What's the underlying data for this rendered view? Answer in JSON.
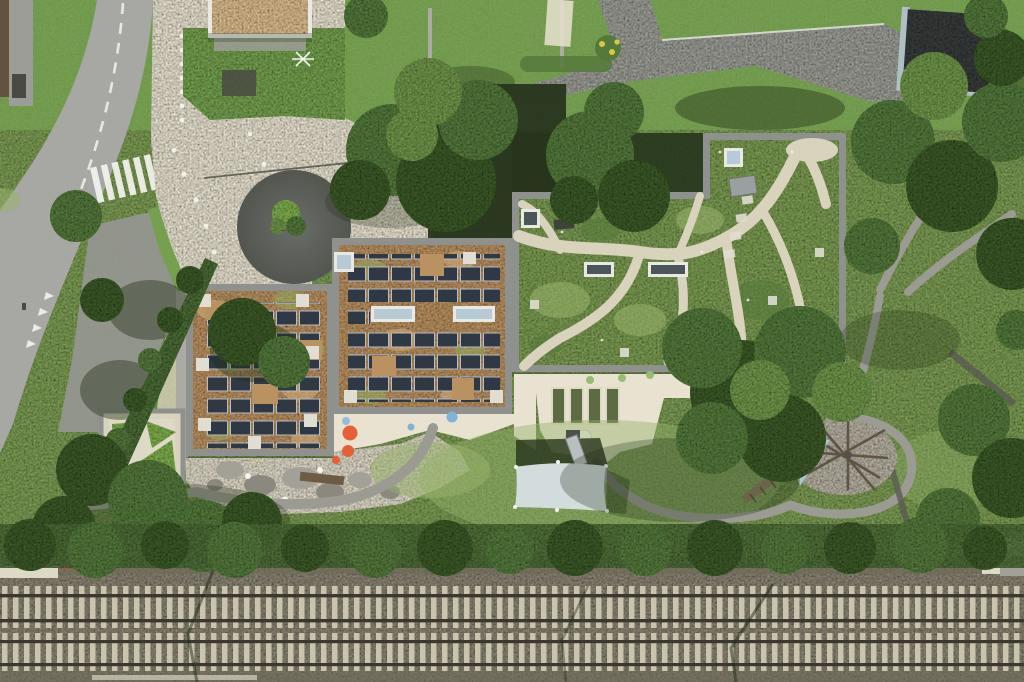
{
  "scene": {
    "type": "aerial-drone-photograph",
    "description": "Top-down aerial view of a kindergarten building with sedum green roofs: two roof sections carry rows of solar panels, a larger eastern roof section is a roof garden with winding gravel paths and skylights. Around the building: an entrance plaza with a dark tree circle, an access road with zebra crossing, neighbouring houses and driveways at the top, a playground with a white shade sail, raised garden beds, a rock garden, a timber climbing structure with a light-blue sail, a small shelter with triangular green roof patches, a hedge row, and a double railway track corridor across the bottom.",
    "features": [
      "curved road with zebra crossing and yield markings",
      "entrance plaza with bollard dots and circular tree planter",
      "west roof: sedum with solar panel array and white service pads",
      "center roof: sedum with solar panels and light-blue skylights",
      "east roof: green roof garden with gravel paths, skylights, vent box",
      "courtyard with orange and blue play dots",
      "four raised garden beds with green dots and white play tent",
      "rock garden with boulders and log",
      "white shade sail over play pit with slide",
      "gravel circle with timber climbing frame and blue triangular sail",
      "shelter roof with three triangular green patches",
      "lawns, large trees, hedge row",
      "two-track railway with sleepers, rails and mast shadows",
      "neighbour house with tan flat roof (top left)",
      "neighbour house with dark roof (top right)"
    ],
    "counts": {
      "railway_tracks": 2,
      "rails_visible": 4,
      "solar_roof_sections": 2,
      "garden_beds": 4,
      "shade_sails": 2
    }
  },
  "colors": {
    "grass": "#7d9c55",
    "grassLight": "#95b16a",
    "grassDark": "#5f813f",
    "lawn": "#74a050",
    "treeDark": "#3c5a2c",
    "treeMid": "#55793c",
    "treeLight": "#6f954b",
    "treeBright": "#7fae4e",
    "shadow": "#1e2a15",
    "deepShade": "#27351d",
    "road": "#a7a7a3",
    "roadDark": "#95968f",
    "driveway": "#9d9d97",
    "pathGrey": "#9b9b93",
    "plaza": "#e9e2d0",
    "concrete": "#ded8c6",
    "gravelPath": "#d9d2bd",
    "parapet": "#8e918d",
    "wallGrey": "#abaaa4",
    "sedumTan": "#ba9160",
    "sedumGreen": "#93a75e",
    "sedumLight": "#d0ab79",
    "roofGreen": "#7c9b52",
    "roofGreenL": "#99b46b",
    "solar": "#2f3945",
    "solarFrame": "#b8bdc3",
    "skyBlue": "#b6cbd5",
    "skyDark": "#4c555a",
    "frameWhite": "#e9e9e4",
    "pad": "#e0ddd2",
    "rock": "#a3a098",
    "rockDark": "#8b887f",
    "sailWhite": "#d3dcdd",
    "sailBlue": "#a9c7d7",
    "dotOrange": "#e55f38",
    "dotBlue": "#7fb3d8",
    "dotGreen": "#98bd72",
    "ballast": "#8a8472",
    "ballastDark": "#6e6958",
    "sleeper": "#cac3ae",
    "rail": "#3a382f",
    "hedge": "#4c6c39",
    "houseTan": "#dcbc8e",
    "houseDark": "#3a3d3c",
    "houseTrim": "#aec0c4",
    "fenceBrown": "#64523e",
    "wood": "#8b7b5e",
    "woodDark": "#5f5443",
    "slideGrey": "#b9bfc0",
    "red": "#c2453a",
    "yellow": "#d9c941",
    "white": "#f3f3ef",
    "darkObject": "#4a4a44",
    "plazaCircle": "#5e615c"
  }
}
